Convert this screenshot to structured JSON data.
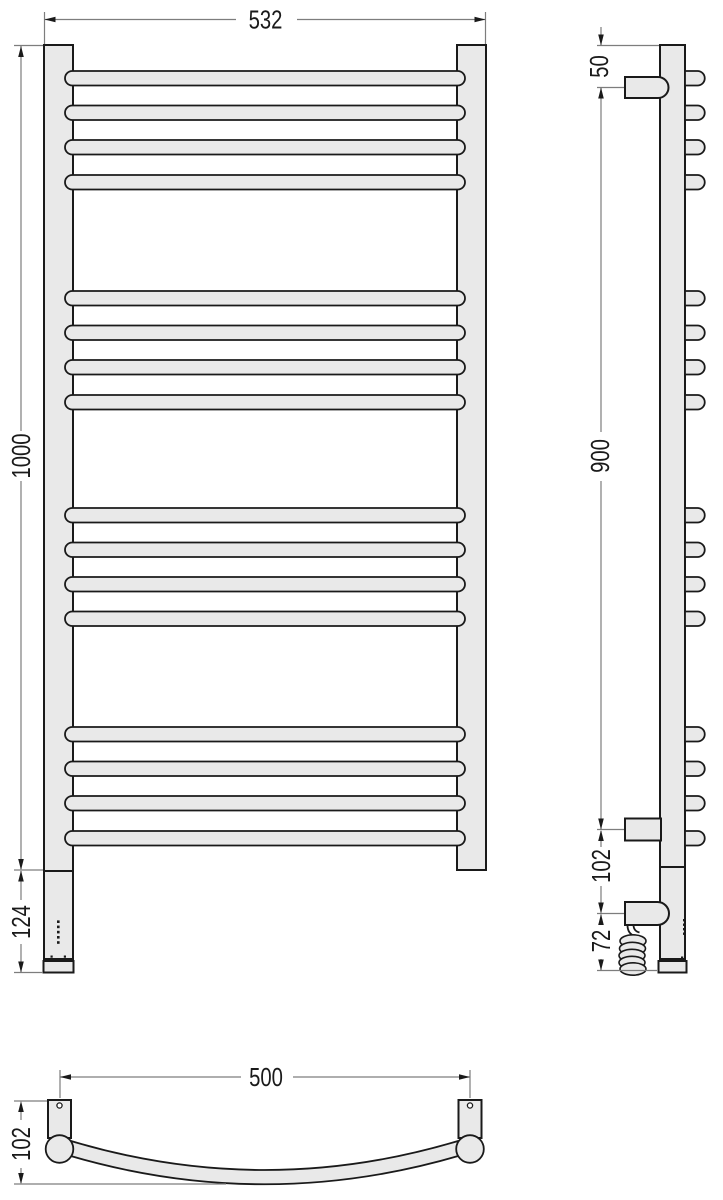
{
  "drawing": {
    "front_view": {
      "width_label": "532",
      "height_label": "1000",
      "bottom_section_label": "124"
    },
    "side_view": {
      "top_offset_label": "50",
      "bracket_span_label": "900",
      "lower_gap_label": "102",
      "cable_offset_label": "72"
    },
    "bottom_view": {
      "mount_distance_label": "500",
      "depth_label": "102"
    }
  },
  "colors": {
    "outline": "#1a1a1a",
    "fill": "#e9e9e9",
    "dim_line": "#7d7d7d",
    "background": "#ffffff"
  }
}
